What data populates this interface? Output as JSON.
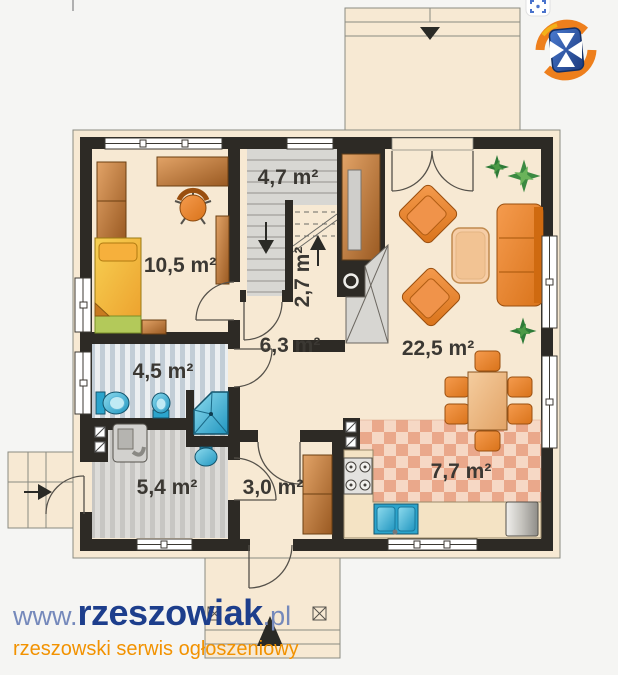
{
  "watermark": {
    "www": "www.",
    "brand": "rzeszowiak",
    "tld": ".pl",
    "tagline": "rzeszowski serwis ogłoszeniowy",
    "brand_color": "#1d3e8c",
    "prefix_color": "#7589bb",
    "tagline_color": "#f29200"
  },
  "logo": {
    "name": "rzeszowiak-shield-logo",
    "shield_color": "#2a55a4",
    "swoosh_color": "#ee7f1c",
    "accent_color": "#f3b21a",
    "cross_color": "#ffffff"
  },
  "overlay_icon": {
    "name": "screenshot-frame-icon",
    "color": "#4a73cc"
  },
  "floorplan": {
    "palette": {
      "wall": "#2d2a25",
      "floor": "#f7e9d3",
      "furniture_orange": "#e9841f",
      "wood": "#b06a2a",
      "fixture_blue": "#2ba4cc",
      "plant_green": "#2e7b38",
      "stair_grey": "#d8d7d3",
      "kitchen_tile": "#eaa88b",
      "bathroom_tile": "#c2cdd6",
      "label_text": "#3b3833"
    },
    "rooms": [
      {
        "name": "bedroom",
        "area": "10,5 m²"
      },
      {
        "name": "staircase",
        "area": "4,7 m²"
      },
      {
        "name": "staircase-flight",
        "area": "2,7 m²"
      },
      {
        "name": "hall",
        "area": "6,3 m²"
      },
      {
        "name": "living-room",
        "area": "22,5 m²"
      },
      {
        "name": "bathroom",
        "area": "4,5 m²"
      },
      {
        "name": "utility-room",
        "area": "5,4 m²"
      },
      {
        "name": "vestibule",
        "area": "3,0 m²"
      },
      {
        "name": "kitchen",
        "area": "7,7 m²"
      }
    ]
  }
}
